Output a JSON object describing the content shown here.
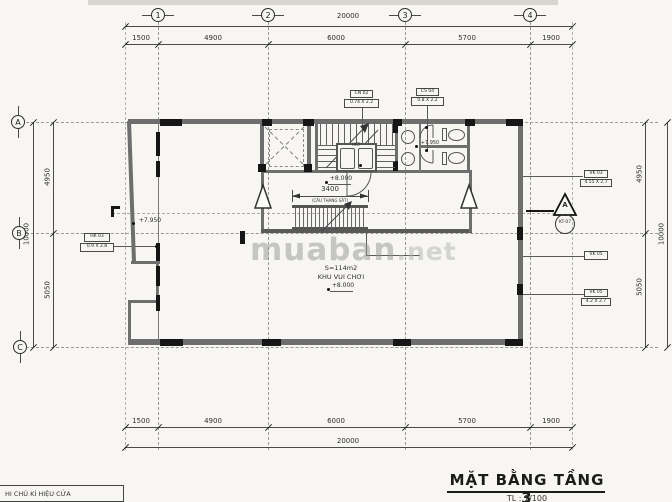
{
  "title": {
    "main": "MẶT BẰNG TẦNG 3",
    "scale": "TL : 1/100"
  },
  "note_table": {
    "header": "HI CHÚ KÍ HIỆU CỬA"
  },
  "watermark": {
    "part1": "muaban",
    "part2": ".net"
  },
  "grid": {
    "cols": [
      "1",
      "2",
      "3",
      "4"
    ],
    "rows": [
      "A",
      "B",
      "C"
    ]
  },
  "dimensions": {
    "top_total": "20000",
    "top_segments": [
      "1500",
      "4900",
      "6000",
      "5700",
      "1900"
    ],
    "bottom_segments": [
      "1500",
      "4900",
      "6000",
      "5700",
      "1900"
    ],
    "bottom_total": "20000",
    "left_total": "10000",
    "left_segments": [
      "4950",
      "5050"
    ],
    "right_segments": [
      "4950",
      "5050"
    ],
    "right_total": "10000",
    "ladder_width": "3400"
  },
  "labels": {
    "area": "S=114m2",
    "room": "KHU VUI CHƠI",
    "level_800_room": "+8.000",
    "level_800_stair": "+8.000",
    "level_795_left": "+7.950",
    "level_795_wc": "+7.950",
    "ladder": "(CẦU THANG SẮT)",
    "hkt": "HKT"
  },
  "tags": {
    "door_left": {
      "code": "HK 03",
      "size": "0.9 X 2.8"
    },
    "door_top1": {
      "code": "CN 02",
      "size": "0.74 X 2.2"
    },
    "door_top2": {
      "code": "CS 04",
      "size": "0.8 X 2.2"
    },
    "window_right1": {
      "code": "VK 03",
      "size": "4.55 X 2.7"
    },
    "window_right2": {
      "code": "VK 05"
    },
    "window_right3": {
      "code": "VK 05",
      "size": "4.2 X 2.7"
    }
  },
  "section_marker": {
    "letter": "A",
    "sheet": "KT-07"
  },
  "colors": {
    "line": "#4a4a4a",
    "wall": "#6e6e6e",
    "black": "#161616",
    "paper": "#f7f6f2"
  }
}
